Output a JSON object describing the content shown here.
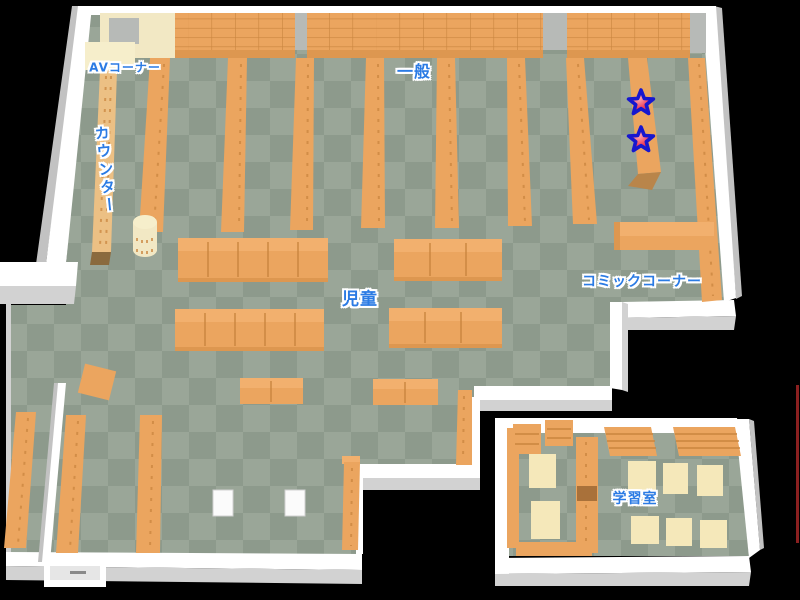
{
  "map": {
    "labels": {
      "av": "AVコーナー",
      "counter": "カウンター",
      "general": "一般",
      "children": "児童",
      "comic": "コミックコーナー",
      "study": "学習室"
    },
    "markers": [
      {
        "id": "star-marker-1",
        "x": 641,
        "y": 103
      },
      {
        "id": "star-marker-2",
        "x": 641,
        "y": 140
      }
    ],
    "colors": {
      "floor_light": "#9aa698",
      "floor_dark": "#8d9a8c",
      "shelf": "#eba55f",
      "shelf_light": "#f2b06e",
      "shelf_dark": "#dd9750",
      "shelf_edge": "#c9853f",
      "shelf_shadow": "#b9854a",
      "wall": "#ffffff",
      "wall_shade": "#d2d2d2",
      "wall_dark": "#c2c2c2",
      "pillar": "#b7bab7",
      "cream": "#f2e8c4",
      "cream_light": "#f6eecb",
      "table": "#f5e8ba",
      "counter": "#ecc084",
      "counter_cap": "#8a6a3e",
      "label": "#2b7be4",
      "star_fill": "#ee3b55",
      "star_fill_light": "#ffb3bb",
      "star_stroke": "#1717cf",
      "red_line": "#8b2020"
    }
  }
}
